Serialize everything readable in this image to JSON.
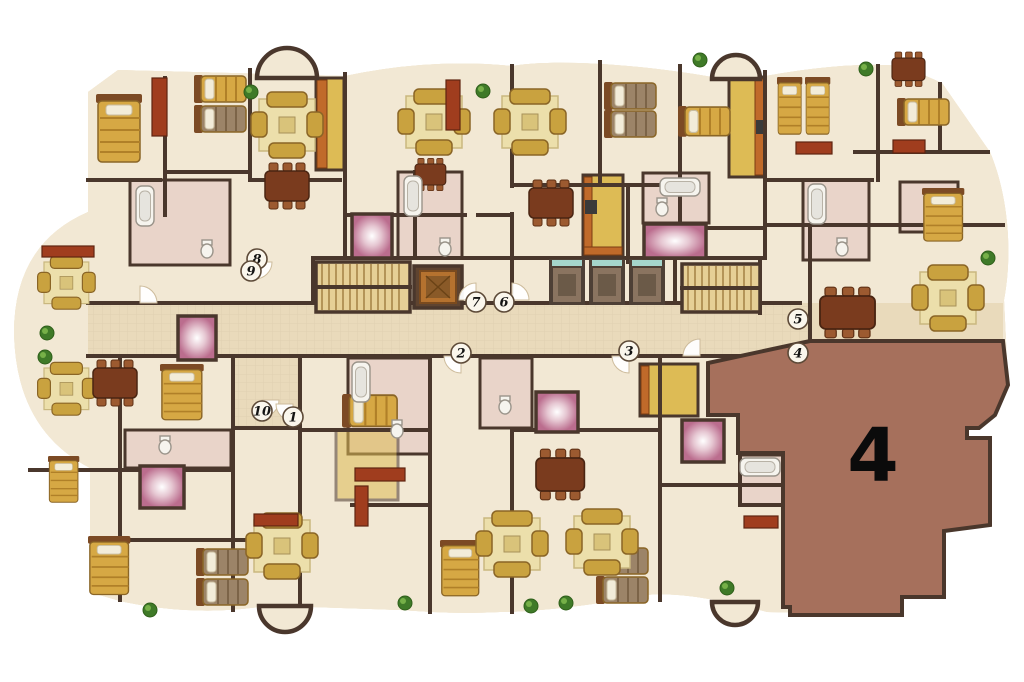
{
  "plan": {
    "unit_label": "4",
    "markers": [
      {
        "label": "1",
        "x": 293,
        "y": 417
      },
      {
        "label": "2",
        "x": 461,
        "y": 353
      },
      {
        "label": "3",
        "x": 629,
        "y": 351
      },
      {
        "label": "4",
        "x": 798,
        "y": 353
      },
      {
        "label": "5",
        "x": 798,
        "y": 319
      },
      {
        "label": "6",
        "x": 504,
        "y": 302
      },
      {
        "label": "7",
        "x": 476,
        "y": 302
      },
      {
        "label": "8",
        "x": 257,
        "y": 259
      },
      {
        "label": "9",
        "x": 251,
        "y": 271
      },
      {
        "label": "10",
        "x": 262,
        "y": 411
      }
    ],
    "colors": {
      "background": "#ffffff",
      "floor": "#f2e8d4",
      "floor_grid": "#d8c9ac",
      "corridor": "#e9dabb",
      "wall": "#4a372c",
      "glass": "#a5d6cc",
      "highlight": "#a6705c",
      "glow_center": "#ffffff",
      "glow_mid": "#e6c7d2",
      "glow_edge": "#bb6d8e",
      "bath": "#e9d4c9",
      "kitchen": "#ddbb55",
      "counter": "#c06a2a",
      "rug": "#ecdfab",
      "sofa": "#c9a23f",
      "wood": "#7a3b1e",
      "chair": "#9c5a30",
      "desk": "#a03d1e",
      "bed": "#d6a844",
      "bed_stripe": "#b08028",
      "bed_alt": "#9c8468",
      "bed_alt_stripe": "#7c6448",
      "bed_head": "#7c4a24",
      "pillow": "#f2ecd9",
      "stairs": "#e6cf96",
      "stair_tread": "#a8854a",
      "lift_frame": "#4e4036",
      "lift_inside": "#8a7460",
      "plant": "#3f7a28",
      "plant_light": "#76b048",
      "fixture": "#f6f4ee",
      "marker_fill": "#faf6ec",
      "marker_stroke": "#5d4a38",
      "label": "#0b0b0b"
    }
  }
}
